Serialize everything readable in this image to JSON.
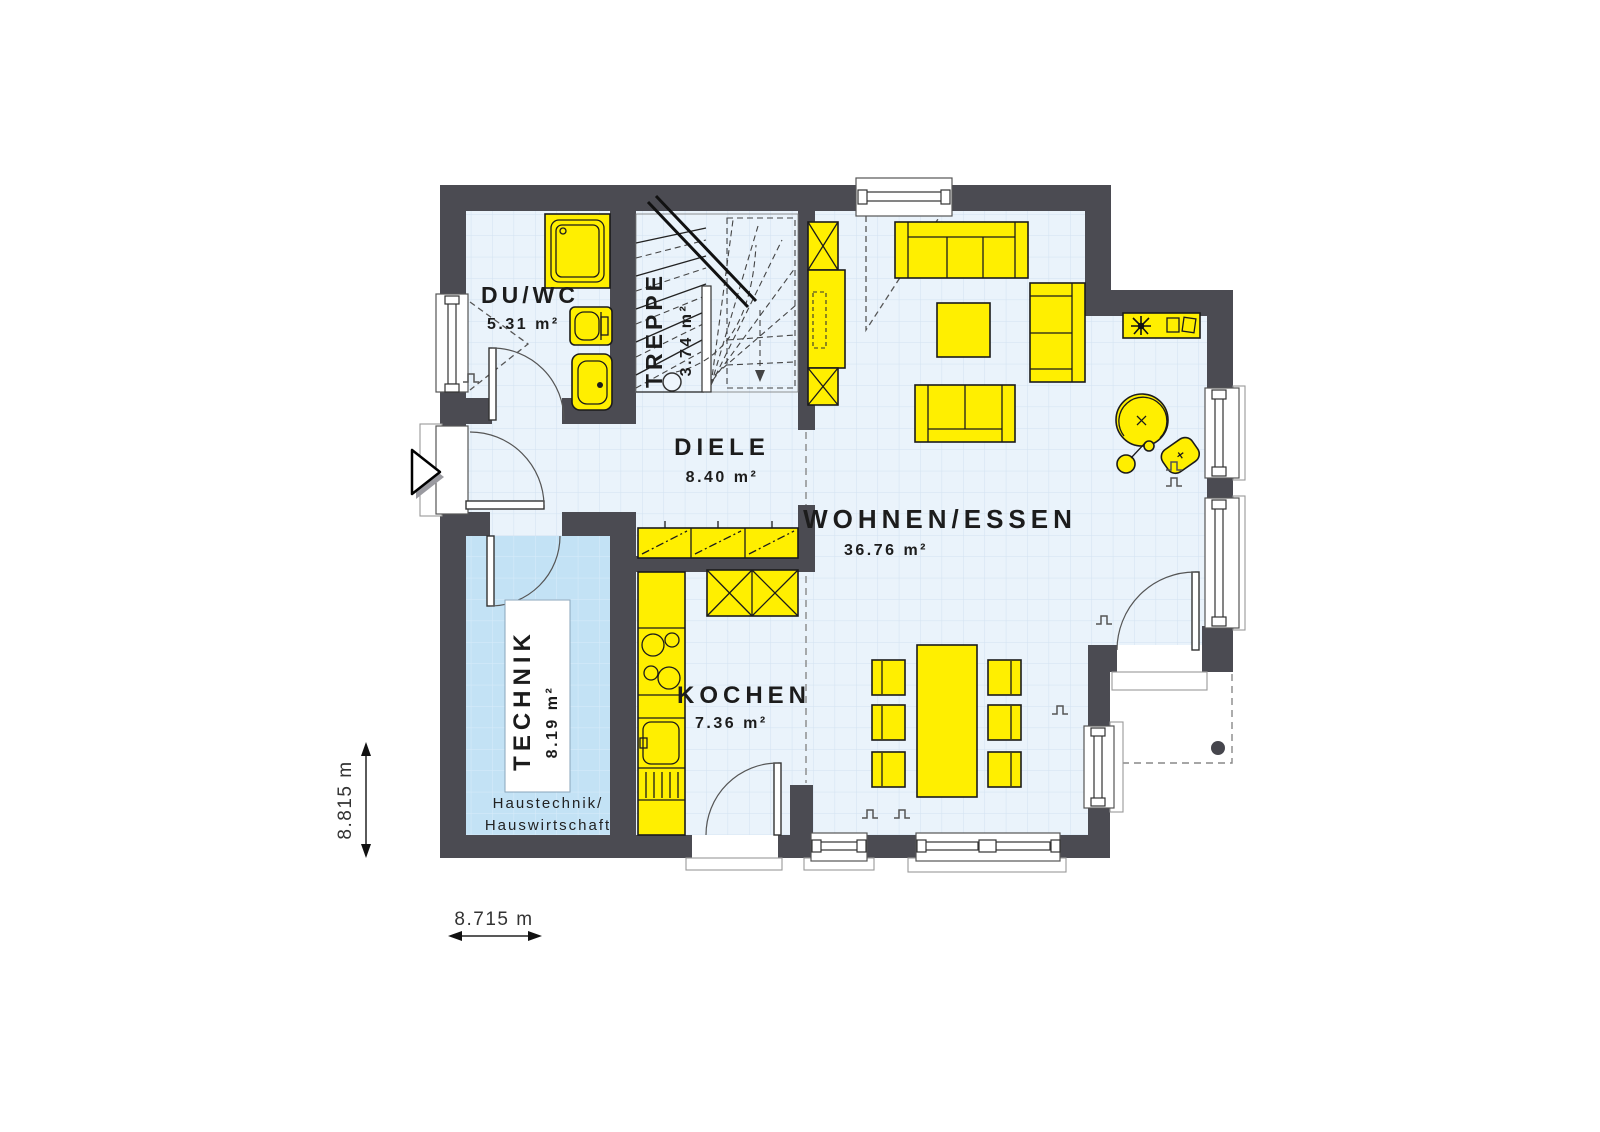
{
  "plan": {
    "rooms": {
      "duwc": {
        "label": "DU/WC",
        "area": "5.31 m²"
      },
      "treppe": {
        "label": "TREPPE",
        "area": "3.74 m²"
      },
      "diele": {
        "label": "DIELE",
        "area": "8.40 m²"
      },
      "wohnen": {
        "label": "WOHNEN/ESSEN",
        "area": "36.76 m²"
      },
      "kochen": {
        "label": "KOCHEN",
        "area": "7.36 m²"
      },
      "technik": {
        "label": "TECHNIK",
        "area": "8.19 m²",
        "note_line1": "Haustechnik/",
        "note_line2": "Hauswirtschaft"
      }
    },
    "dimensions": {
      "height_label": "8.815 m",
      "width_label": "8.715 m"
    },
    "colors": {
      "wall": "#4b4b52",
      "furniture": "#ffef00",
      "floor": "#eaf3fb",
      "floor_grid": "#d2e2f1",
      "technik_floor": "#c3e2f5"
    }
  }
}
